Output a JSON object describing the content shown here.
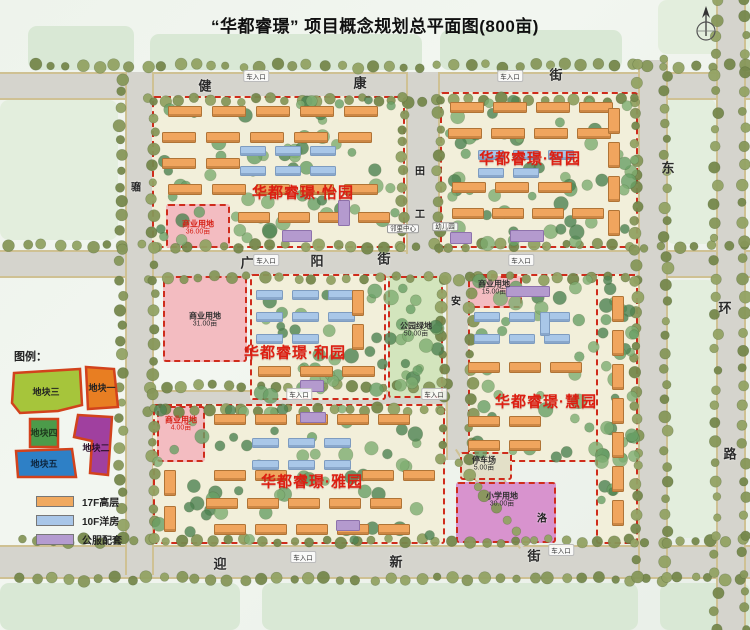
{
  "title": "“华都睿璟” 项目概念规划总平面图(800亩)",
  "compass_icon": "north-compass-icon",
  "map_legend": {
    "title": "图例：",
    "parcels": [
      {
        "label": "地块三",
        "color": "#a6c53b"
      },
      {
        "label": "地块一",
        "color": "#e87e22"
      },
      {
        "label": "地块四",
        "color": "#4c9b4a"
      },
      {
        "label": "地块二",
        "color": "#a0409f"
      },
      {
        "label": "地块五",
        "color": "#2e80c6"
      }
    ]
  },
  "type_legend": [
    {
      "label": "17F高层",
      "color": "#f0a95f"
    },
    {
      "label": "10F洋房",
      "color": "#a9c6e8"
    },
    {
      "label": "公服配套",
      "color": "#b49bd0"
    }
  ],
  "streets": [
    {
      "name": "健康街",
      "minor": false,
      "chars": [
        {
          "t": "健",
          "x": 205,
          "y": 85
        },
        {
          "t": "康",
          "x": 360,
          "y": 82
        },
        {
          "t": "街",
          "x": 556,
          "y": 74
        }
      ]
    },
    {
      "name": "广阳街",
      "minor": false,
      "chars": [
        {
          "t": "广",
          "x": 247,
          "y": 262
        },
        {
          "t": "阳",
          "x": 317,
          "y": 260
        },
        {
          "t": "街",
          "x": 384,
          "y": 258
        }
      ]
    },
    {
      "name": "迎新街",
      "minor": false,
      "chars": [
        {
          "t": "迎",
          "x": 220,
          "y": 563
        },
        {
          "t": "新",
          "x": 396,
          "y": 561
        },
        {
          "t": "街",
          "x": 534,
          "y": 555
        }
      ]
    },
    {
      "name": "东环路",
      "minor": false,
      "chars": [
        {
          "t": "东",
          "x": 668,
          "y": 167
        },
        {
          "t": "环",
          "x": 725,
          "y": 307
        },
        {
          "t": "路",
          "x": 730,
          "y": 453
        }
      ]
    },
    {
      "name": "骝",
      "minor": true,
      "chars": [
        {
          "t": "骝",
          "x": 136,
          "y": 186
        }
      ]
    },
    {
      "name": "田工",
      "minor": true,
      "chars": [
        {
          "t": "田",
          "x": 420,
          "y": 170
        },
        {
          "t": "工",
          "x": 420,
          "y": 213
        }
      ]
    },
    {
      "name": "安",
      "minor": true,
      "chars": [
        {
          "t": "安",
          "x": 456,
          "y": 300
        }
      ]
    },
    {
      "name": "洛",
      "minor": true,
      "chars": [
        {
          "t": "洛",
          "x": 542,
          "y": 517
        }
      ]
    }
  ],
  "districts": [
    {
      "label": "华都睿璟·怡园",
      "x": 303,
      "y": 192
    },
    {
      "label": "华都睿璟·智园",
      "x": 530,
      "y": 158
    },
    {
      "label": "华都睿璟·和园",
      "x": 295,
      "y": 352
    },
    {
      "label": "华都睿璟·慧园",
      "x": 546,
      "y": 401
    },
    {
      "label": "华都睿璟·雅园",
      "x": 312,
      "y": 481
    }
  ],
  "land_labels": [
    {
      "text": "商业用地",
      "sub": "36.00亩",
      "x": 198,
      "y": 228,
      "variant": "red"
    },
    {
      "text": "商业用地",
      "sub": "31.00亩",
      "x": 205,
      "y": 320,
      "variant": "dark"
    },
    {
      "text": "商业用地",
      "sub": "15.00亩",
      "x": 494,
      "y": 288,
      "variant": "dark"
    },
    {
      "text": "商业用地",
      "sub": "4.00亩",
      "x": 181,
      "y": 424,
      "variant": "red"
    },
    {
      "text": "公园绿地",
      "sub": "50.00亩",
      "x": 416,
      "y": 330,
      "variant": "dark"
    },
    {
      "text": "停车场",
      "sub": "5.00亩",
      "x": 484,
      "y": 464,
      "variant": "dark"
    },
    {
      "text": "小学用地",
      "sub": "30.00亩",
      "x": 502,
      "y": 500,
      "variant": "dark"
    },
    {
      "text": "幼儿园",
      "sub": "",
      "x": 445,
      "y": 227,
      "variant": "tag"
    },
    {
      "text": "邻里中心",
      "sub": "",
      "x": 403,
      "y": 229,
      "variant": "tag"
    }
  ],
  "entrances": [
    {
      "label": "车入口",
      "x": 256,
      "y": 76
    },
    {
      "label": "车入口",
      "x": 510,
      "y": 76
    },
    {
      "label": "车入口",
      "x": 266,
      "y": 260
    },
    {
      "label": "车入口",
      "x": 521,
      "y": 260
    },
    {
      "label": "车入口",
      "x": 299,
      "y": 394
    },
    {
      "label": "车入口",
      "x": 434,
      "y": 394
    },
    {
      "label": "车入口",
      "x": 303,
      "y": 557
    },
    {
      "label": "车入口",
      "x": 561,
      "y": 550
    }
  ]
}
